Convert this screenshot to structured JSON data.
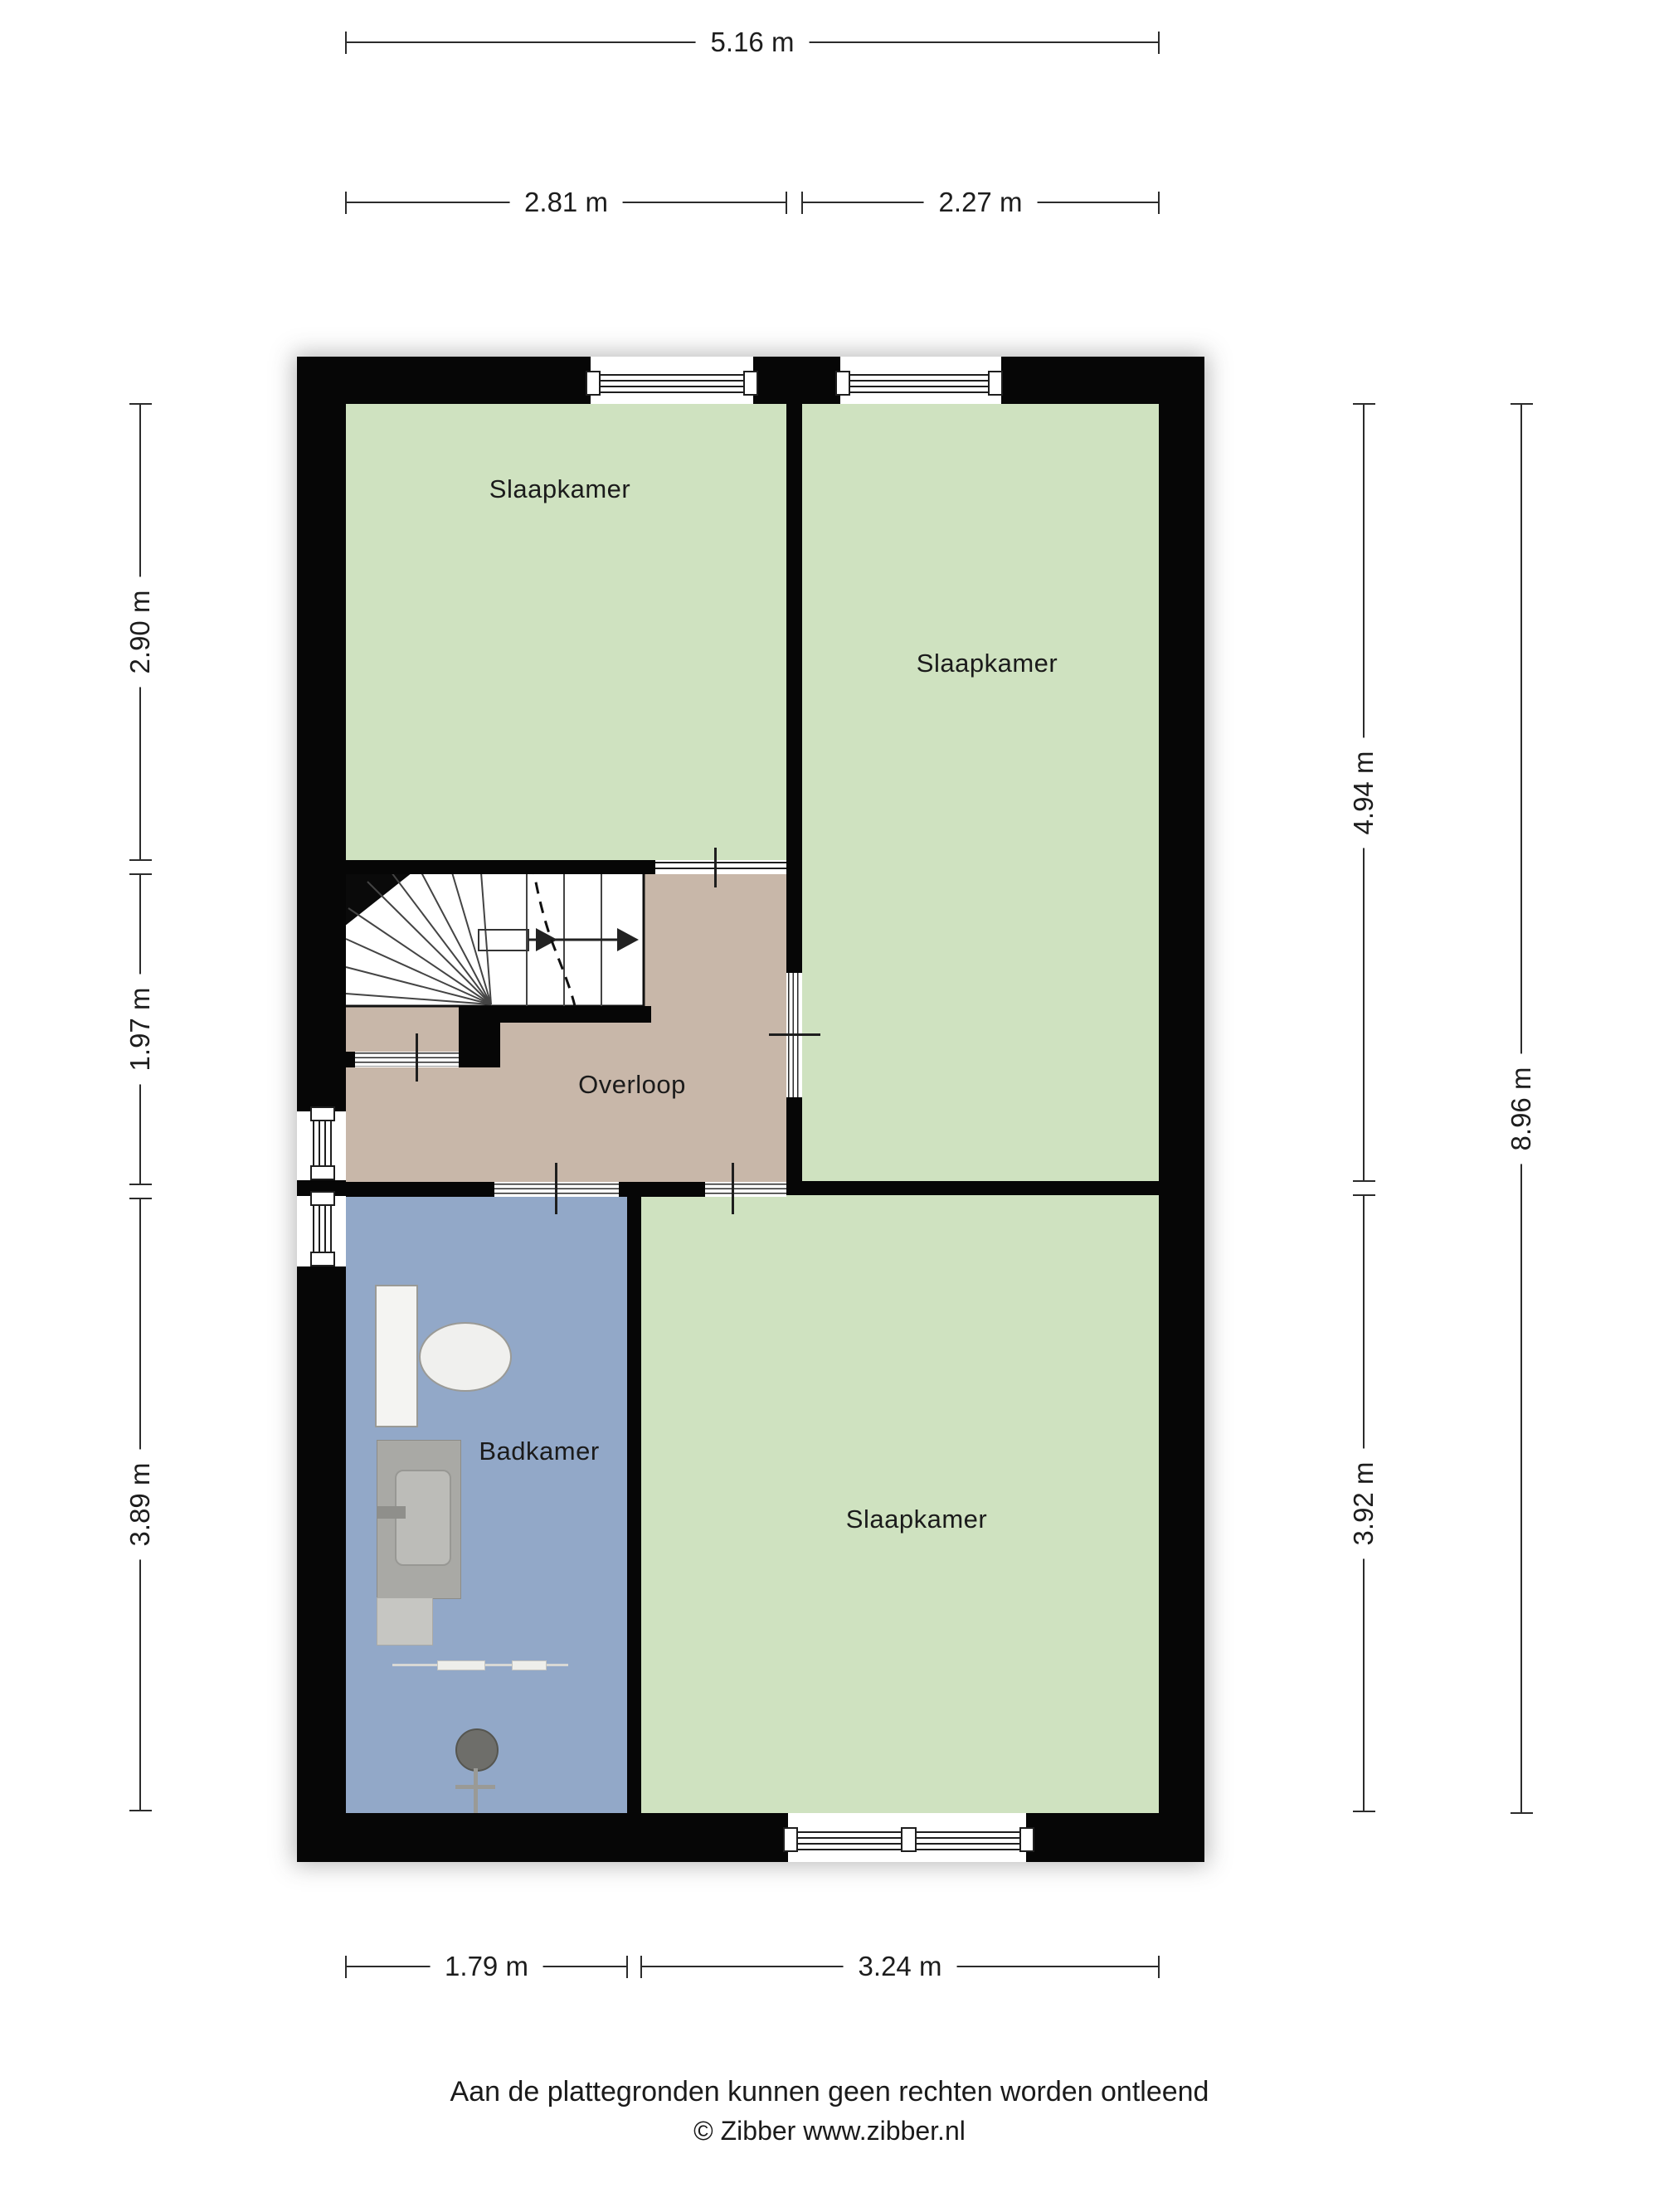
{
  "floorplan": {
    "rooms": [
      {
        "id": "bedroom-top-left",
        "label": "Slaapkamer"
      },
      {
        "id": "bedroom-top-right",
        "label": "Slaapkamer"
      },
      {
        "id": "landing",
        "label": "Overloop"
      },
      {
        "id": "bathroom",
        "label": "Badkamer"
      },
      {
        "id": "bedroom-bottom-right",
        "label": "Slaapkamer"
      }
    ],
    "dimensions": {
      "top_total": "5.16 m",
      "top_left": "2.81 m",
      "top_right": "2.27 m",
      "left_top": "2.90 m",
      "left_middle": "1.97 m",
      "left_bottom": "3.89 m",
      "right_upper": "4.94 m",
      "right_lower": "3.92 m",
      "right_total": "8.96 m",
      "bottom_left": "1.79 m",
      "bottom_right": "3.24 m"
    },
    "footer_line1": "Aan de plattegronden kunnen geen rechten worden ontleend",
    "footer_line2": "© Zibber www.zibber.nl",
    "colors": {
      "bedroom": "#cfe2c0",
      "landing": "#c8b7a9",
      "bathroom": "#92a8c8",
      "wall": "#060606"
    }
  }
}
